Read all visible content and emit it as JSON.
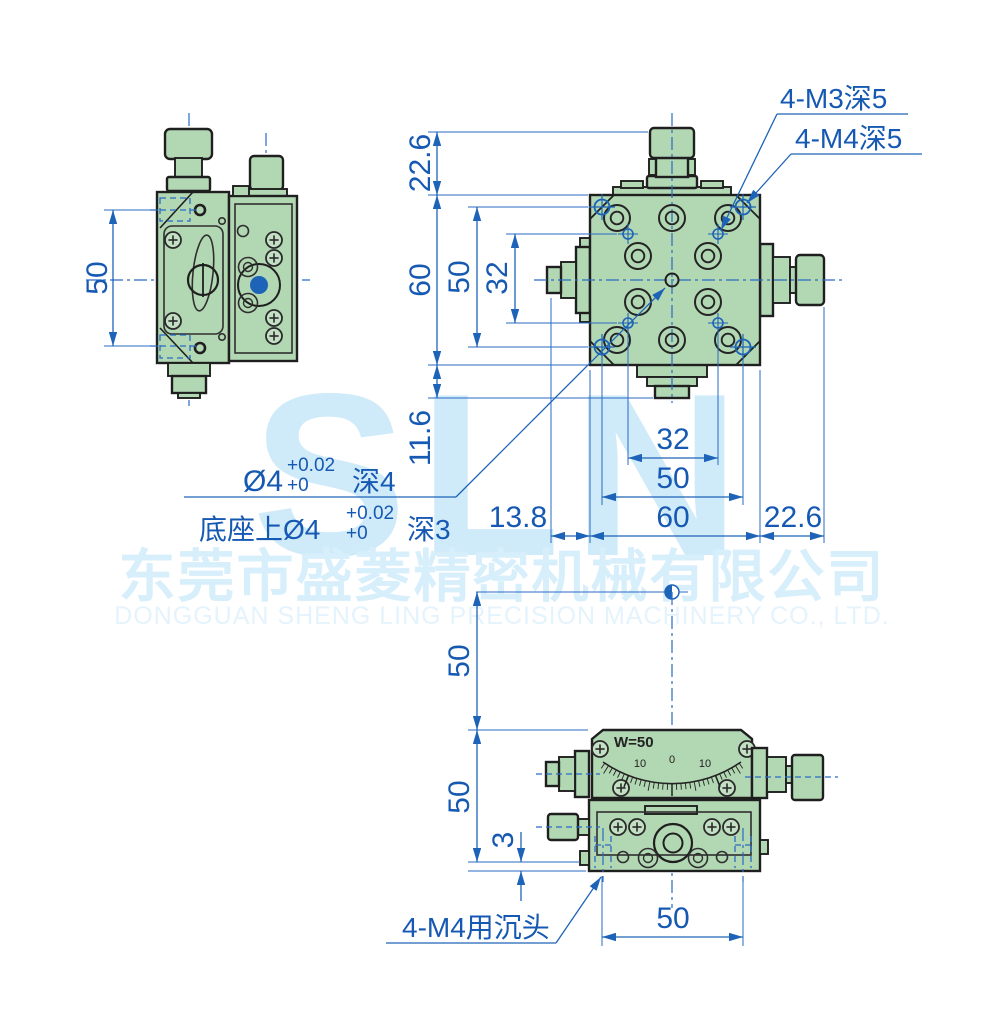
{
  "watermark": {
    "logo_text": "SLN",
    "company_cn": "东莞市盛菱精密机械有限公司",
    "company_en": "DONGGUAN SHENG LING PRECISION MACHINERY CO., LTD."
  },
  "side_view": {
    "height_dim": "50"
  },
  "top_view": {
    "callouts": {
      "m3": "4-M3深5",
      "m4": "4-M4深5"
    },
    "left_dims": {
      "top_knob": "22.6",
      "body": "60",
      "mount_holes": "50",
      "inner_holes": "32",
      "bottom_knob": "11.6"
    },
    "bottom_dims": {
      "inner_holes": "32",
      "mount_holes": "50",
      "body": "60",
      "right_knob": "22.6",
      "left_shaft": "13.8"
    },
    "center_note": {
      "l1_dia": "Ø4",
      "l1_tol_up": "+0.02",
      "l1_tol_dn": "+0",
      "l1_depth": "深4",
      "l2_dia": "底座上Ø4",
      "l2_tol_up": "+0.02",
      "l2_tol_dn": "+0",
      "l2_depth": "深3"
    }
  },
  "front_view": {
    "travel_label": "W=50",
    "scale_labels": {
      "left": "10",
      "center": "0",
      "right": "10"
    },
    "left_dims": {
      "rotation_center": "50",
      "body_height": "50",
      "flange": "3"
    },
    "bottom_dim": "50",
    "callout_counterbore": "4-M4用沉头"
  }
}
